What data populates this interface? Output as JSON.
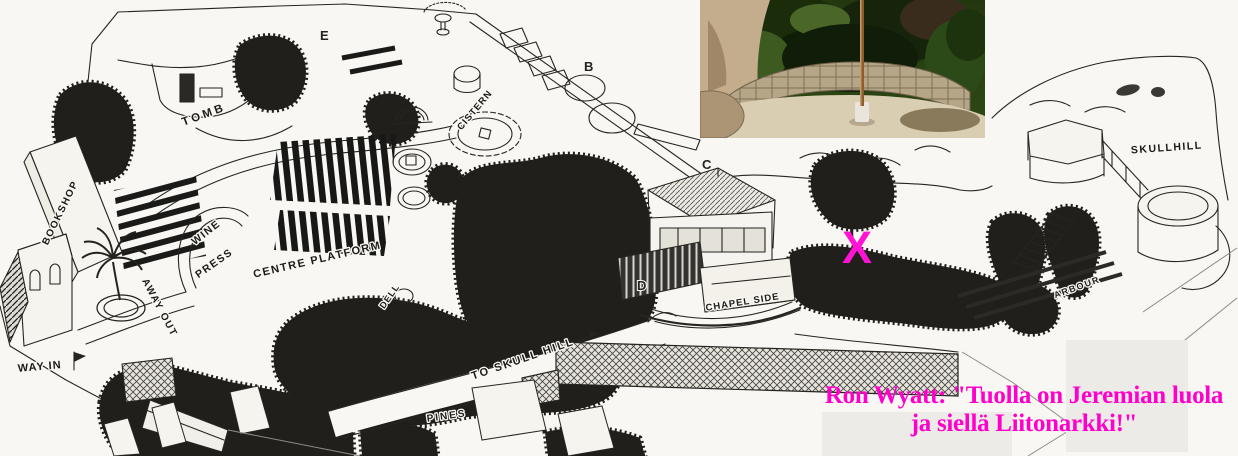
{
  "caption": {
    "line1": "Ron Wyatt: \"Tuolla on Jeremian luola",
    "line2": "ja siellä Liitonarkki!\"",
    "color": "#ff00cc"
  },
  "x_marker": {
    "glyph": "X",
    "color": "#ff14d6"
  },
  "map_labels": {
    "tomb": "TOMB",
    "bookshop": "BOOKSHOP",
    "wine": "WINE",
    "press": "PRESS",
    "centre_platform": "CENTRE PLATFORM",
    "cistern": "CISTERN",
    "dell": "DELL",
    "to_skull_hill": "TO SKULL HILL",
    "pines": "PINES",
    "chapel_side": "CHAPEL SIDE",
    "arbour": "ARBOUR",
    "skull_hill": "SKULLHILL",
    "way_in": "WAY IN",
    "away_out": "AWAY OUT"
  },
  "map_letters": {
    "e": "E",
    "b": "B",
    "c": "C",
    "d": "D"
  },
  "photo_inset": {
    "name": "garden-courtyard-photo"
  }
}
